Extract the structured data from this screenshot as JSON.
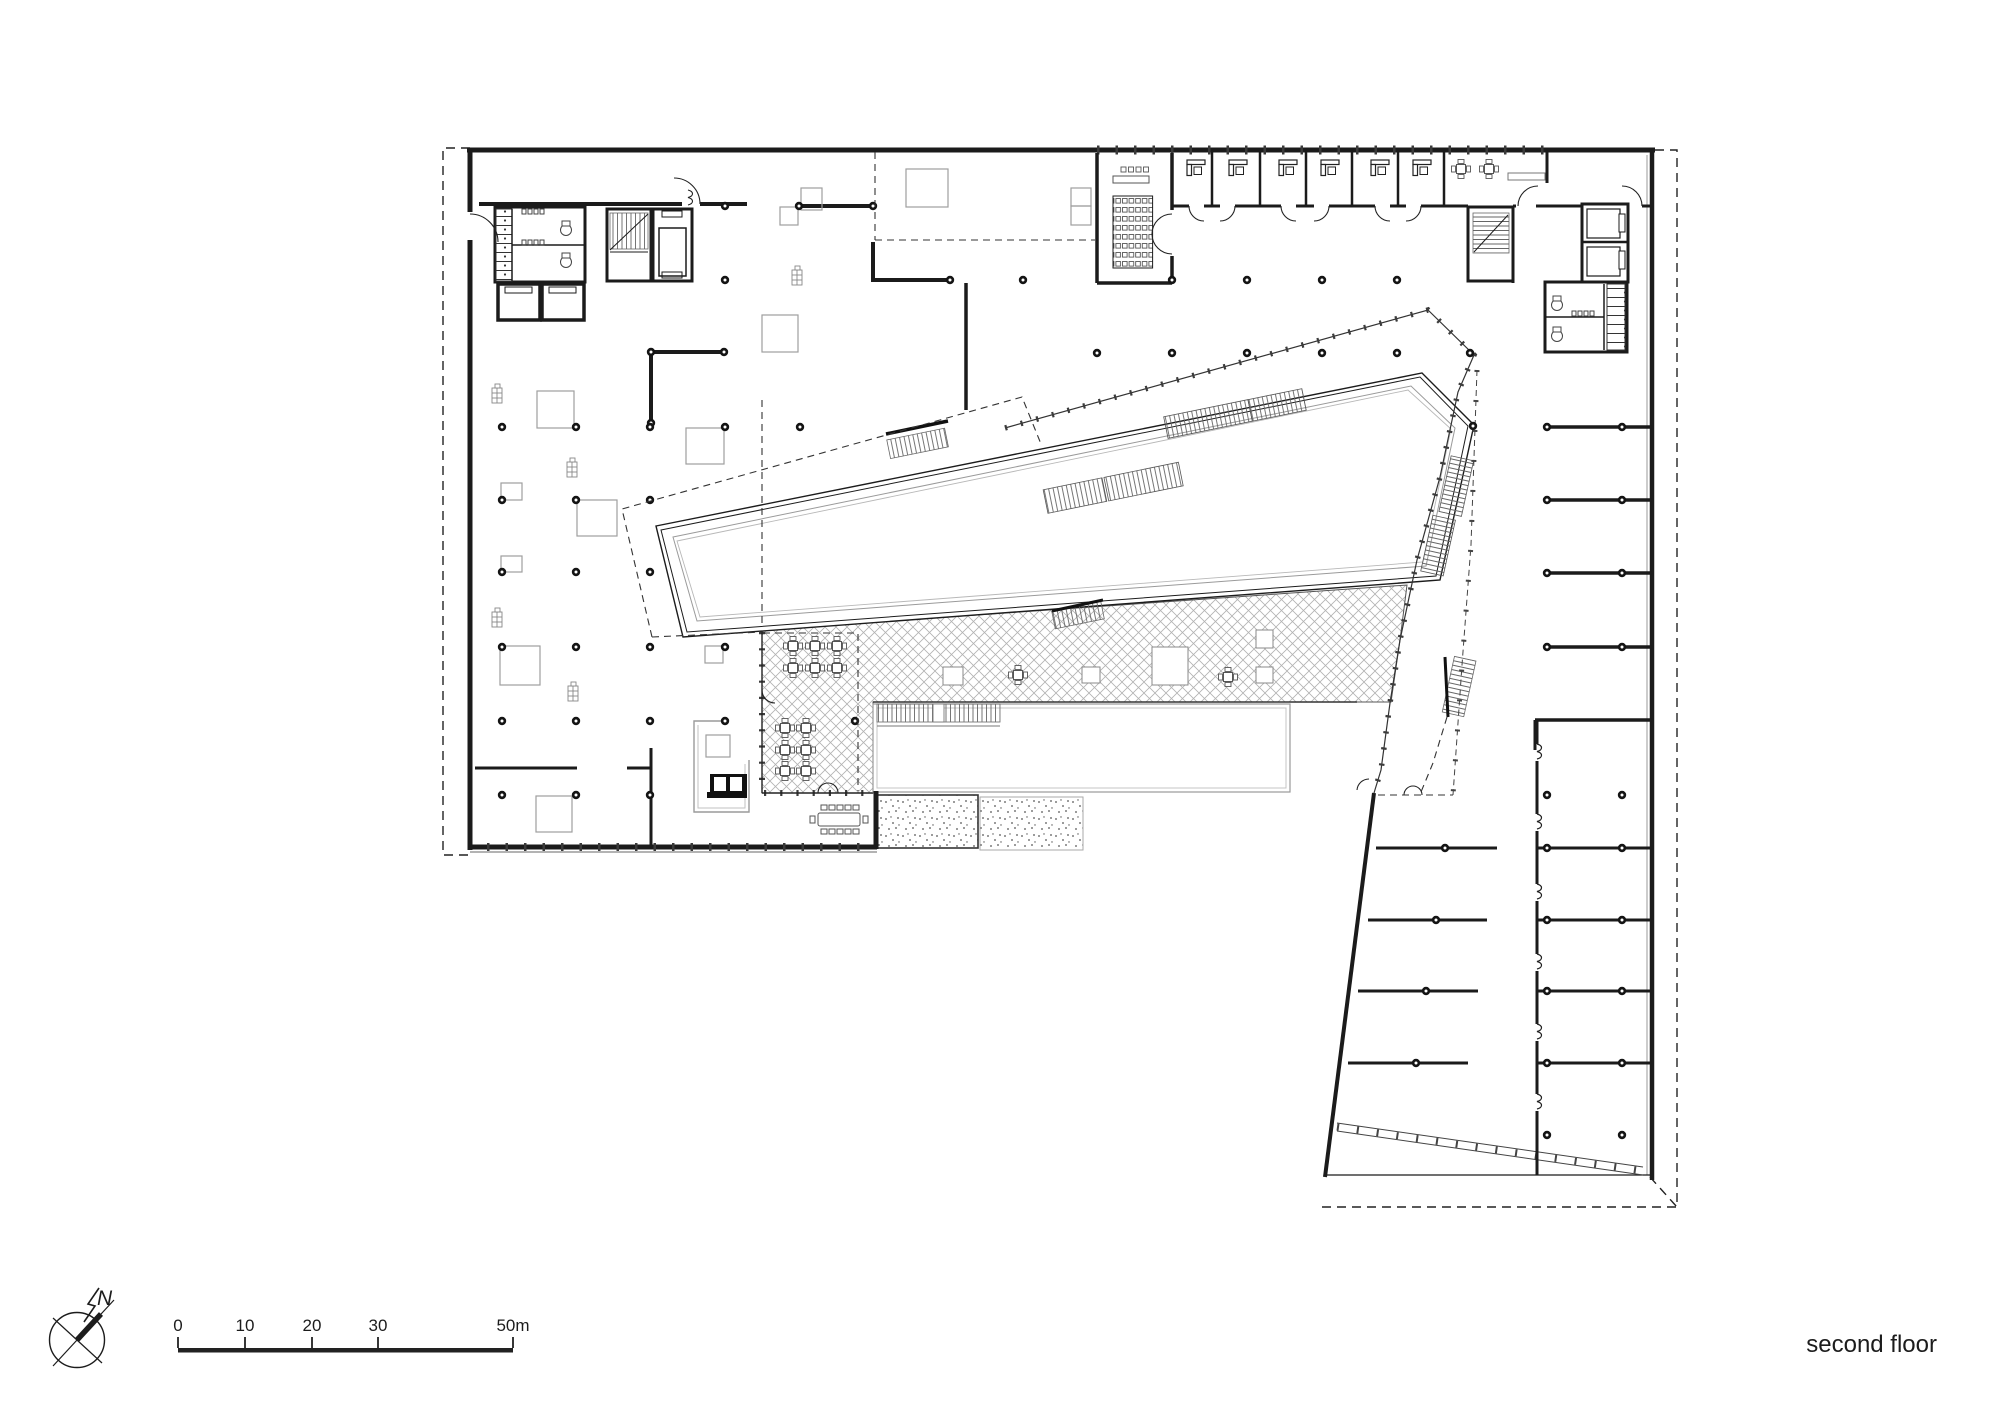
{
  "title": {
    "label": "second floor"
  },
  "compass": {
    "label": "N"
  },
  "scalebar": {
    "unit": "m",
    "ticks": [
      {
        "label": "0"
      },
      {
        "label": "10"
      },
      {
        "label": "20"
      },
      {
        "label": "30"
      },
      {
        "label": "50m"
      }
    ]
  },
  "palette": {
    "ink": "#1c1c1c",
    "mid": "#555555",
    "light": "#9a9a9a",
    "hatch": "#b2b2b2",
    "paper": "#ffffff"
  },
  "plan": {
    "type": "architectural-floor-plan",
    "floor_label": "second floor",
    "scale_total_m": 50
  }
}
